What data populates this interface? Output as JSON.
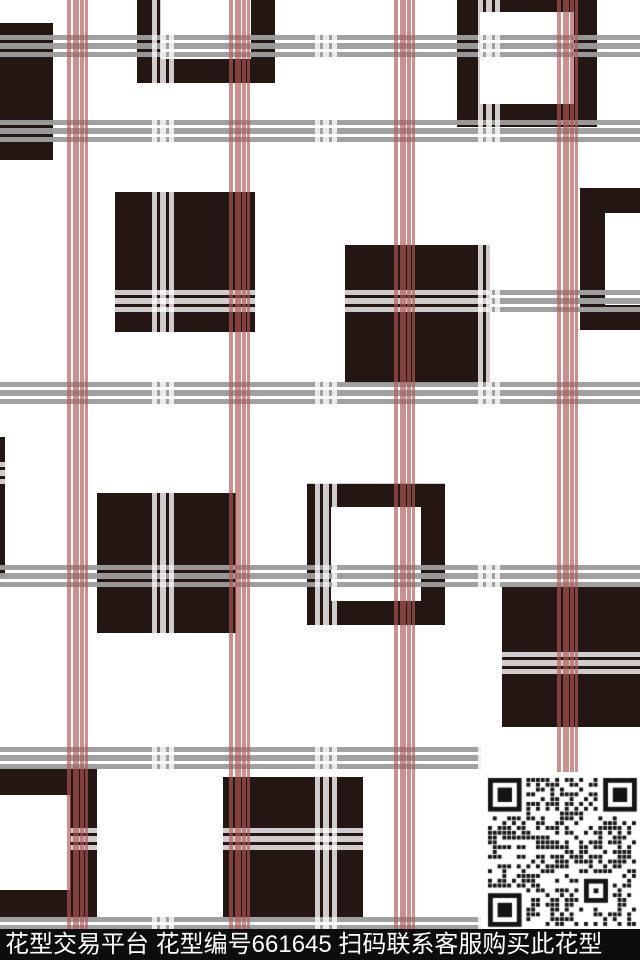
{
  "bottom_bar": {
    "text": "花型交易平台 花型编号661645 扫码联系客服购买此花型",
    "platform": "花型交易平台",
    "pattern_code_label": "花型编号",
    "pattern_code": "661645",
    "cta": "扫码联系客服购买此花型",
    "bg": "#0d0d0d",
    "fg": "#ffffff"
  },
  "qr": {
    "x": 481,
    "y": 772,
    "w": 159,
    "h": 158,
    "seed": 661645,
    "color": "#141414"
  },
  "pattern": {
    "colors": {
      "background": "#ffffff",
      "square": "#241612",
      "pink_stripe": "rgba(176,88,86,0.66)",
      "white_stripe": "rgba(255,255,255,0.78)",
      "gray_stripe": "rgba(157,157,157,0.96)"
    },
    "squares": [
      {
        "type": "solid",
        "x": 0,
        "y": 23,
        "w": 53,
        "h": 137
      },
      {
        "type": "frame",
        "x": 137,
        "y": -60,
        "w": 138,
        "h": 143,
        "border": 24
      },
      {
        "type": "frame",
        "x": 457,
        "y": -11,
        "w": 140,
        "h": 138,
        "border": 23
      },
      {
        "type": "solid",
        "x": 115,
        "y": 192,
        "w": 140,
        "h": 140
      },
      {
        "type": "solid",
        "x": 345,
        "y": 245,
        "w": 145,
        "h": 138
      },
      {
        "type": "frame",
        "x": 580,
        "y": 188,
        "w": 122,
        "h": 142,
        "border": 25
      },
      {
        "type": "frame",
        "x": 307,
        "y": 483,
        "w": 138,
        "h": 142,
        "border": 24
      },
      {
        "type": "solid",
        "x": -10,
        "y": 437,
        "w": 15,
        "h": 140
      },
      {
        "type": "solid",
        "x": 97,
        "y": 493,
        "w": 139,
        "h": 140
      },
      {
        "type": "solid",
        "x": 223,
        "y": 777,
        "w": 140,
        "h": 140
      },
      {
        "type": "frame",
        "x": -62,
        "y": 768,
        "w": 159,
        "h": 149,
        "border": 27
      },
      {
        "type": "solid",
        "x": 502,
        "y": 587,
        "w": 148,
        "h": 140
      }
    ],
    "stripes": {
      "pink_vertical_x": [
        66,
        228,
        393,
        556
      ],
      "white_vertical_x": [
        152,
        315,
        478
      ],
      "gray_horizontal": [
        {
          "y": 35,
          "x": 0,
          "w": 640
        },
        {
          "y": 120,
          "x": 0,
          "w": 640
        },
        {
          "y": 382,
          "x": 0,
          "w": 640
        },
        {
          "y": 565,
          "x": 0,
          "w": 640
        },
        {
          "y": 747,
          "x": 0,
          "w": 481
        },
        {
          "y": 917,
          "x": 0,
          "w": 640
        },
        {
          "y": 290,
          "x": 488,
          "w": 152
        }
      ],
      "white_horizontal_y": [
        290,
        462,
        652,
        828
      ],
      "vertical_extent": 930
    }
  }
}
